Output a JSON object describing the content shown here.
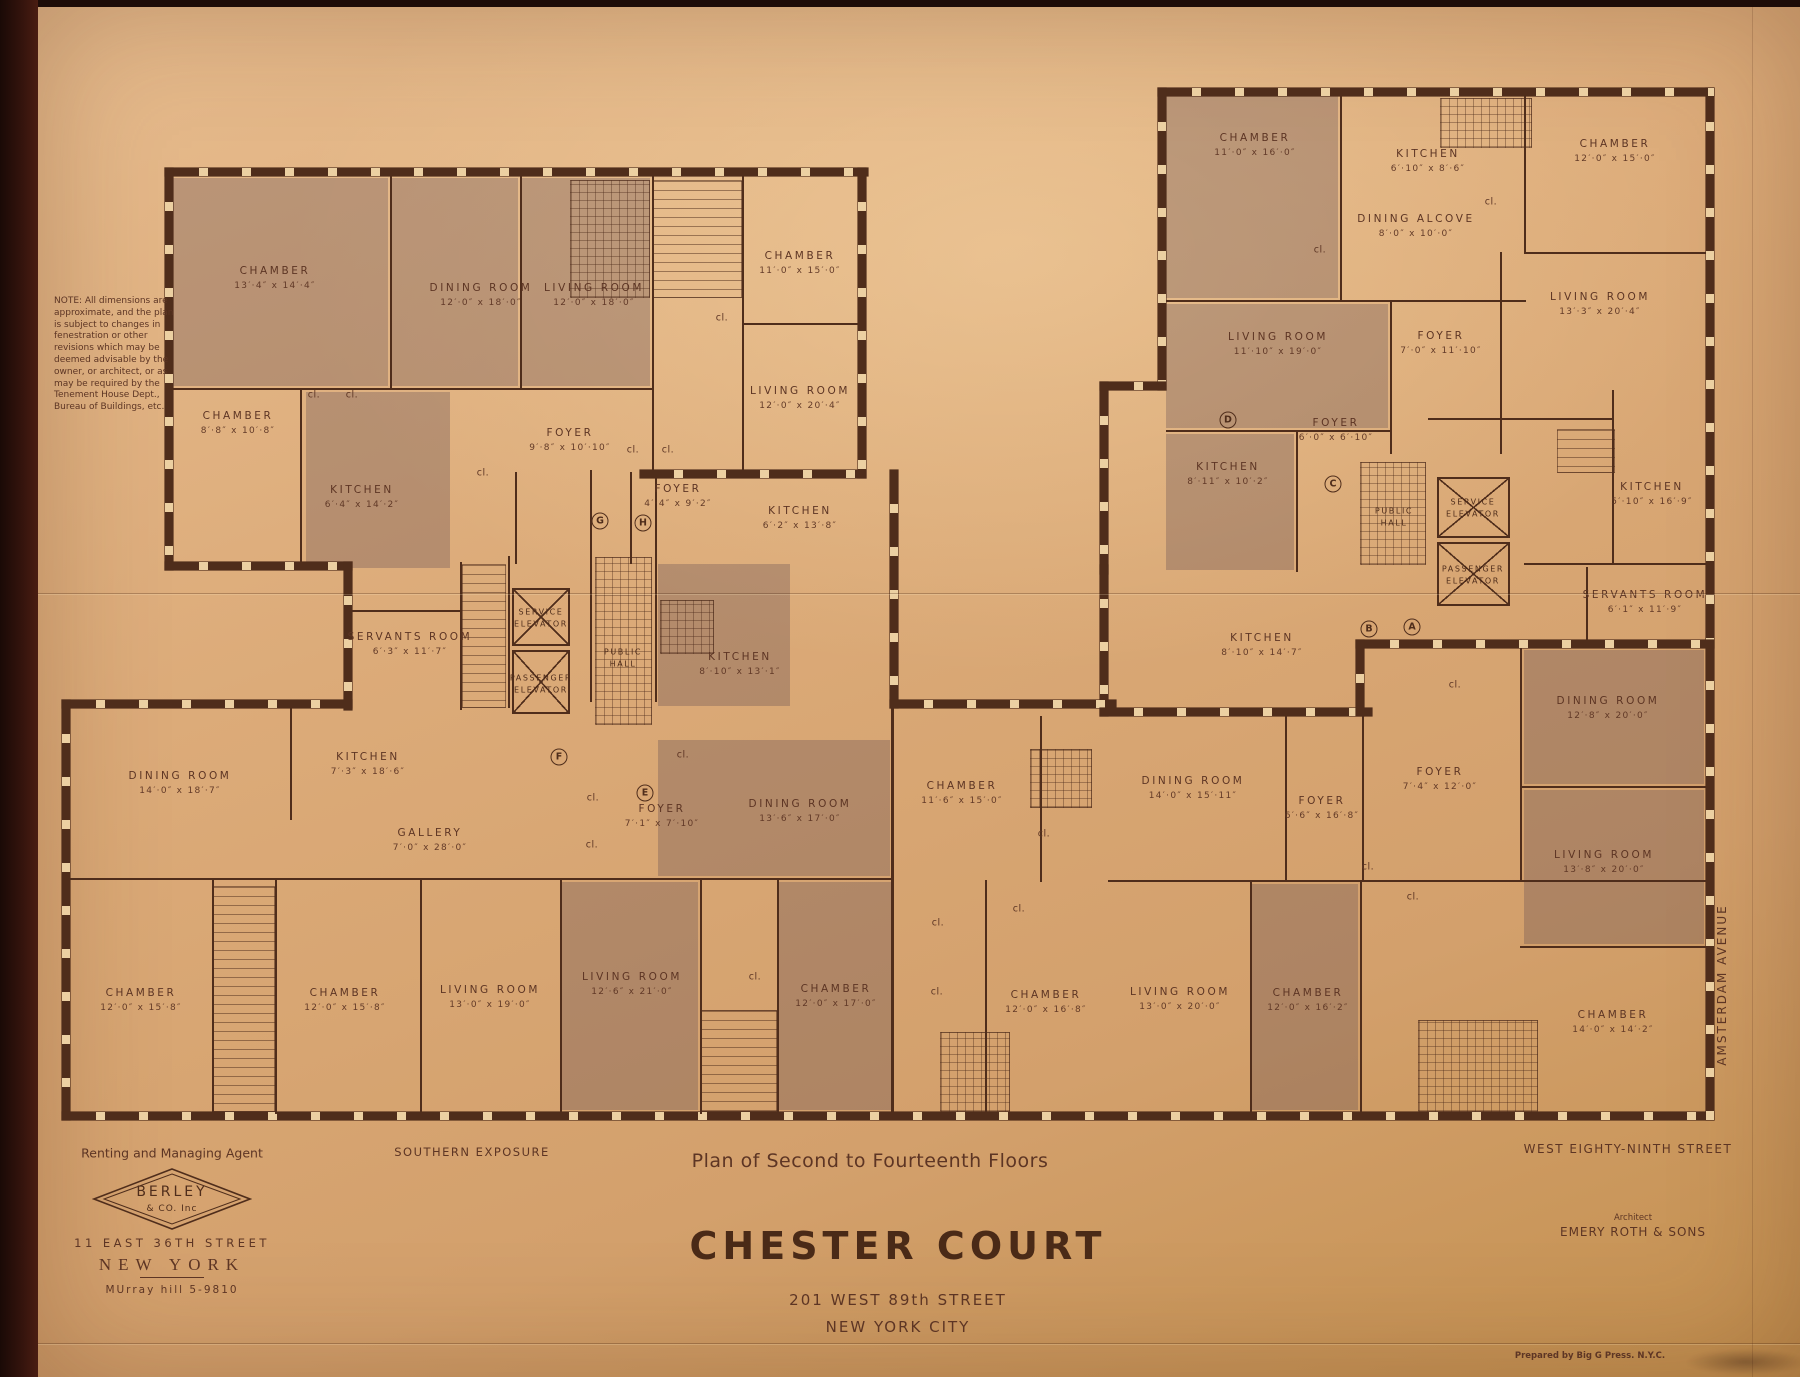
{
  "note": "NOTE:  All dimensions are approximate, and the plan is subject to changes in fenestration or other revisions which may be deemed advisable by the owner, or architect, or as may be required by the Tenement House Dept., Bureau of Buildings, etc.",
  "title_block": {
    "plan_label": "Plan of Second to Fourteenth Floors",
    "building_name": "CHESTER COURT",
    "address": "201 WEST 89th STREET",
    "city": "NEW YORK CITY"
  },
  "agent": {
    "heading": "Renting and Managing Agent",
    "logo_line1": "BERLEY",
    "logo_line2": "& CO. Inc",
    "address": "11 EAST 36TH STREET",
    "city": "NEW YORK",
    "phone": "MUrray hill 5-9810"
  },
  "street_labels": {
    "south": "SOUTHERN EXPOSURE",
    "west89": "WEST EIGHTY-NINTH STREET",
    "amsterdam": "AMSTERDAM AVENUE"
  },
  "architect": {
    "heading": "Architect",
    "name": "EMERY ROTH & SONS"
  },
  "printer": "Prepared by Big G Press. N.Y.C.",
  "closet_label": "cl.",
  "colors": {
    "paper": "#d9a873",
    "ink": "#4f2d1b",
    "shade": "#b3917e"
  },
  "rooms": [
    {
      "label": "CHAMBER",
      "dims": "13′·4″ x 14′·4″",
      "x": 275,
      "y": 278
    },
    {
      "label": "DINING ROOM",
      "dims": "12′·0″ x 18′·0″",
      "x": 481,
      "y": 295
    },
    {
      "label": "LIVING ROOM",
      "dims": "12′·0″ x 18′·0″",
      "x": 594,
      "y": 295
    },
    {
      "label": "CHAMBER",
      "dims": "11′·0″ x 15′·0″",
      "x": 800,
      "y": 263
    },
    {
      "label": "LIVING ROOM",
      "dims": "12′·0″ x 20′·4″",
      "x": 800,
      "y": 398
    },
    {
      "label": "CHAMBER",
      "dims": "8′·8″ x 10′·8″",
      "x": 238,
      "y": 423
    },
    {
      "label": "KITCHEN",
      "dims": "6′·4″ x 14′·2″",
      "x": 362,
      "y": 497
    },
    {
      "label": "FOYER",
      "dims": "9′·8″ x 10′·10″",
      "x": 570,
      "y": 440
    },
    {
      "label": "FOYER",
      "dims": "4′·4″ x 9′·2″",
      "x": 678,
      "y": 496
    },
    {
      "label": "KITCHEN",
      "dims": "6′·2″ x 13′·8″",
      "x": 800,
      "y": 518
    },
    {
      "label": "SERVANTS ROOM",
      "dims": "6′·3″ x 11′·7″",
      "x": 410,
      "y": 644
    },
    {
      "label": "KITCHEN",
      "dims": "8′·10″ x 13′·1″",
      "x": 740,
      "y": 664
    },
    {
      "label": "KITCHEN",
      "dims": "7′·3″ x 18′·6″",
      "x": 368,
      "y": 764
    },
    {
      "label": "GALLERY",
      "dims": "7′·0″ x 28′·0″",
      "x": 430,
      "y": 840
    },
    {
      "label": "DINING ROOM",
      "dims": "14′·0″ x 18′·7″",
      "x": 180,
      "y": 783
    },
    {
      "label": "FOYER",
      "dims": "7′·1″ x 7′·10″",
      "x": 662,
      "y": 816
    },
    {
      "label": "DINING ROOM",
      "dims": "13′·6″ x 17′·0″",
      "x": 800,
      "y": 811
    },
    {
      "label": "CHAMBER",
      "dims": "12′·0″ x 15′·8″",
      "x": 141,
      "y": 1000
    },
    {
      "label": "CHAMBER",
      "dims": "12′·0″ x 15′·8″",
      "x": 345,
      "y": 1000
    },
    {
      "label": "LIVING ROOM",
      "dims": "13′·0″ x 19′·0″",
      "x": 490,
      "y": 997
    },
    {
      "label": "LIVING ROOM",
      "dims": "12′·6″ x 21′·0″",
      "x": 632,
      "y": 984
    },
    {
      "label": "CHAMBER",
      "dims": "12′·0″ x 17′·0″",
      "x": 836,
      "y": 996
    },
    {
      "label": "CHAMBER",
      "dims": "11′·6″ x 15′·0″",
      "x": 962,
      "y": 793
    },
    {
      "label": "CHAMBER",
      "dims": "12′·0″ x 16′·8″",
      "x": 1046,
      "y": 1002
    },
    {
      "label": "DINING ROOM",
      "dims": "14′·0″ x 15′·11″",
      "x": 1193,
      "y": 788
    },
    {
      "label": "FOYER",
      "dims": "6′·6″ x 16′·8″",
      "x": 1322,
      "y": 808
    },
    {
      "label": "LIVING ROOM",
      "dims": "13′·0″ x 20′·0″",
      "x": 1180,
      "y": 999
    },
    {
      "label": "CHAMBER",
      "dims": "12′·0″ x 16′·2″",
      "x": 1308,
      "y": 1000
    },
    {
      "label": "CHAMBER",
      "dims": "14′·0″ x 14′·2″",
      "x": 1613,
      "y": 1022
    },
    {
      "label": "KITCHEN",
      "dims": "8′·10″ x 14′·7″",
      "x": 1262,
      "y": 645
    },
    {
      "label": "FOYER",
      "dims": "7′·4″ x 12′·0″",
      "x": 1440,
      "y": 779
    },
    {
      "label": "DINING ROOM",
      "dims": "12′·8″ x 20′·0″",
      "x": 1608,
      "y": 708
    },
    {
      "label": "LIVING ROOM",
      "dims": "13′·8″ x 20′·0″",
      "x": 1604,
      "y": 862
    },
    {
      "label": "KITCHEN",
      "dims": "5′·10″ x 16′·9″",
      "x": 1652,
      "y": 494
    },
    {
      "label": "SERVANTS ROOM",
      "dims": "6′·1″ x 11′·9″",
      "x": 1645,
      "y": 602
    },
    {
      "label": "CHAMBER",
      "dims": "11′·0″ x 16′·0″",
      "x": 1255,
      "y": 145
    },
    {
      "label": "KITCHEN",
      "dims": "6′·10″ x 8′·6″",
      "x": 1428,
      "y": 161
    },
    {
      "label": "CHAMBER",
      "dims": "12′·0″ x 15′·0″",
      "x": 1615,
      "y": 151
    },
    {
      "label": "DINING ALCOVE",
      "dims": "8′·0″ x 10′·0″",
      "x": 1416,
      "y": 226
    },
    {
      "label": "LIVING ROOM",
      "dims": "13′·3″ x 20′·4″",
      "x": 1600,
      "y": 304
    },
    {
      "label": "LIVING ROOM",
      "dims": "11′·10″ x 19′·0″",
      "x": 1278,
      "y": 344
    },
    {
      "label": "FOYER",
      "dims": "7′·0″ x 11′·10″",
      "x": 1441,
      "y": 343
    },
    {
      "label": "KITCHEN",
      "dims": "8′·11″ x 10′·2″",
      "x": 1228,
      "y": 474
    },
    {
      "label": "FOYER",
      "dims": "6′·0″ x 6′·10″",
      "x": 1336,
      "y": 430
    }
  ],
  "cores": [
    {
      "lines": [
        "SERVICE",
        "ELEVATOR"
      ],
      "x": 541,
      "y": 618
    },
    {
      "lines": [
        "PASSENGER",
        "ELEVATOR"
      ],
      "x": 541,
      "y": 684
    },
    {
      "lines": [
        "PUBLIC",
        "HALL"
      ],
      "x": 623,
      "y": 658
    },
    {
      "lines": [
        "SERVICE",
        "ELEVATOR"
      ],
      "x": 1473,
      "y": 508
    },
    {
      "lines": [
        "PASSENGER",
        "ELEVATOR"
      ],
      "x": 1473,
      "y": 575
    },
    {
      "lines": [
        "PUBLIC",
        "HALL"
      ],
      "x": 1394,
      "y": 517
    }
  ],
  "unit_letters": [
    {
      "t": "G",
      "x": 600,
      "y": 521
    },
    {
      "t": "H",
      "x": 643,
      "y": 523
    },
    {
      "t": "F",
      "x": 559,
      "y": 757
    },
    {
      "t": "E",
      "x": 645,
      "y": 793
    },
    {
      "t": "D",
      "x": 1228,
      "y": 420
    },
    {
      "t": "C",
      "x": 1333,
      "y": 484
    },
    {
      "t": "B",
      "x": 1369,
      "y": 629
    },
    {
      "t": "A",
      "x": 1412,
      "y": 627
    }
  ],
  "closets": [
    [
      314,
      395
    ],
    [
      352,
      395
    ],
    [
      483,
      473
    ],
    [
      633,
      450
    ],
    [
      668,
      450
    ],
    [
      722,
      318
    ],
    [
      683,
      755
    ],
    [
      593,
      798
    ],
    [
      592,
      845
    ],
    [
      755,
      977
    ],
    [
      938,
      923
    ],
    [
      937,
      992
    ],
    [
      1320,
      250
    ],
    [
      1491,
      202
    ],
    [
      1455,
      685
    ],
    [
      1368,
      867
    ],
    [
      1413,
      897
    ],
    [
      1044,
      834
    ],
    [
      1019,
      909
    ]
  ]
}
